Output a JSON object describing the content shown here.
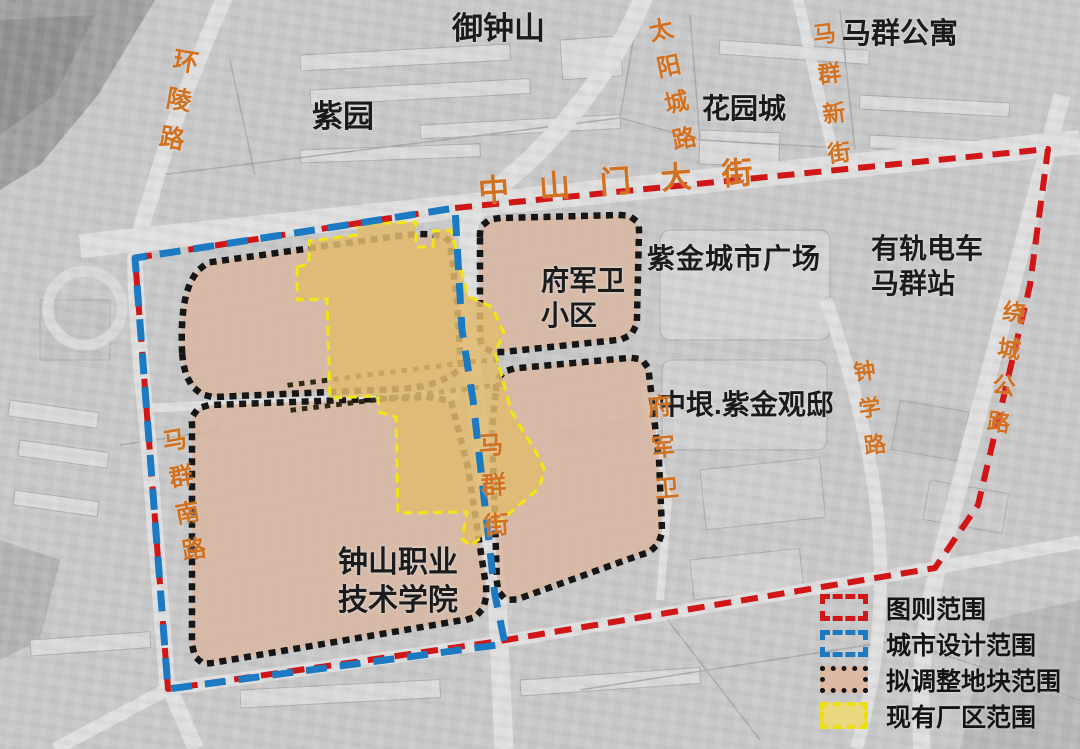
{
  "areas": {
    "yuzhongshan": "御钟山",
    "ziyuan": "紫园",
    "maqun_gongyu": "马群公寓",
    "huayuancheng": "花园城",
    "zijin_plaza": "紫金城市广场",
    "tram_line1": "有轨电车",
    "tram_line2": "马群站",
    "fujunwei_line1": "府军卫",
    "fujunwei_line2": "小区",
    "zhongyin": "中垠.紫金观邸",
    "college_line1": "钟山职业",
    "college_line2": "技术学院"
  },
  "roads": {
    "huanling": "环陵路",
    "taiyangcheng": "太阳城路",
    "maqun_xinjie": "马群新街",
    "zhongshanmen": "中山门大街",
    "maqun_nanlu": "马群南路",
    "maqun_jie": "马群街",
    "fujunwei": "府军卫",
    "zhongxue": "钟学路",
    "raocheng": "绕城公路"
  },
  "legend": {
    "items": [
      {
        "label": "图则范围",
        "color": "#d01616",
        "style": "dashed"
      },
      {
        "label": "城市设计范围",
        "color": "#1b7ac2",
        "style": "dashed"
      },
      {
        "label": "拟调整地块范围",
        "color": "#141414",
        "style": "dotted",
        "fill": "#dcb9a2"
      },
      {
        "label": "现有厂区范围",
        "color": "#eedf10",
        "style": "dashed",
        "fill": "#e9d87e"
      }
    ]
  },
  "colors": {
    "plan_boundary": "#d01616",
    "urban_design_boundary": "#1b7ac2",
    "plot_boundary": "#141414",
    "plot_fill": "#dcb9a2",
    "factory_boundary": "#f2e70c",
    "factory_fill": "#e2bb6e",
    "road_label": "#d2711f",
    "area_label": "#1b1b1b"
  }
}
